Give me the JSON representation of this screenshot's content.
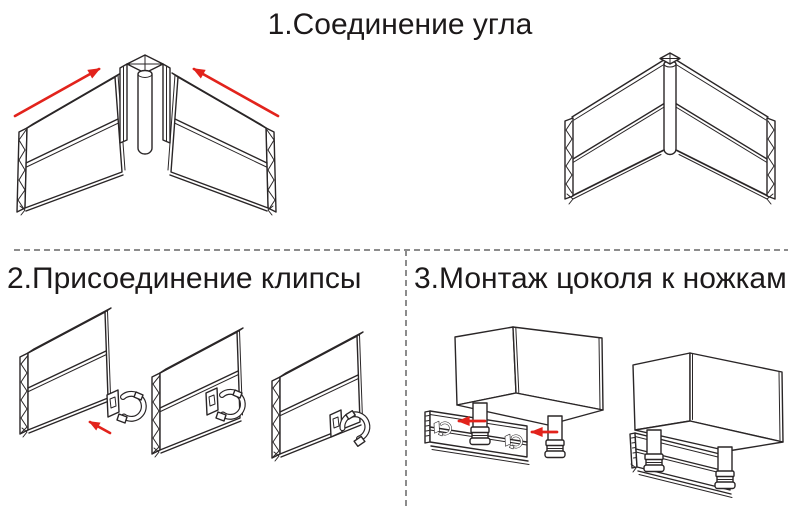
{
  "colors": {
    "background": "#ffffff",
    "line": "#2a2627",
    "text": "#1c191a",
    "accent_red": "#e2231c",
    "divider": "#8c8c8c"
  },
  "steps": [
    {
      "number": "1",
      "title": "1.Соединение угла"
    },
    {
      "number": "2",
      "title": "2.Присоединение клипсы"
    },
    {
      "number": "3",
      "title": "3.Монтаж цоколя к ножкам"
    }
  ],
  "icons": [
    {
      "name": "red-direction-arrow",
      "meaning": "direction of assembly movement",
      "color": "#e2231c"
    }
  ]
}
